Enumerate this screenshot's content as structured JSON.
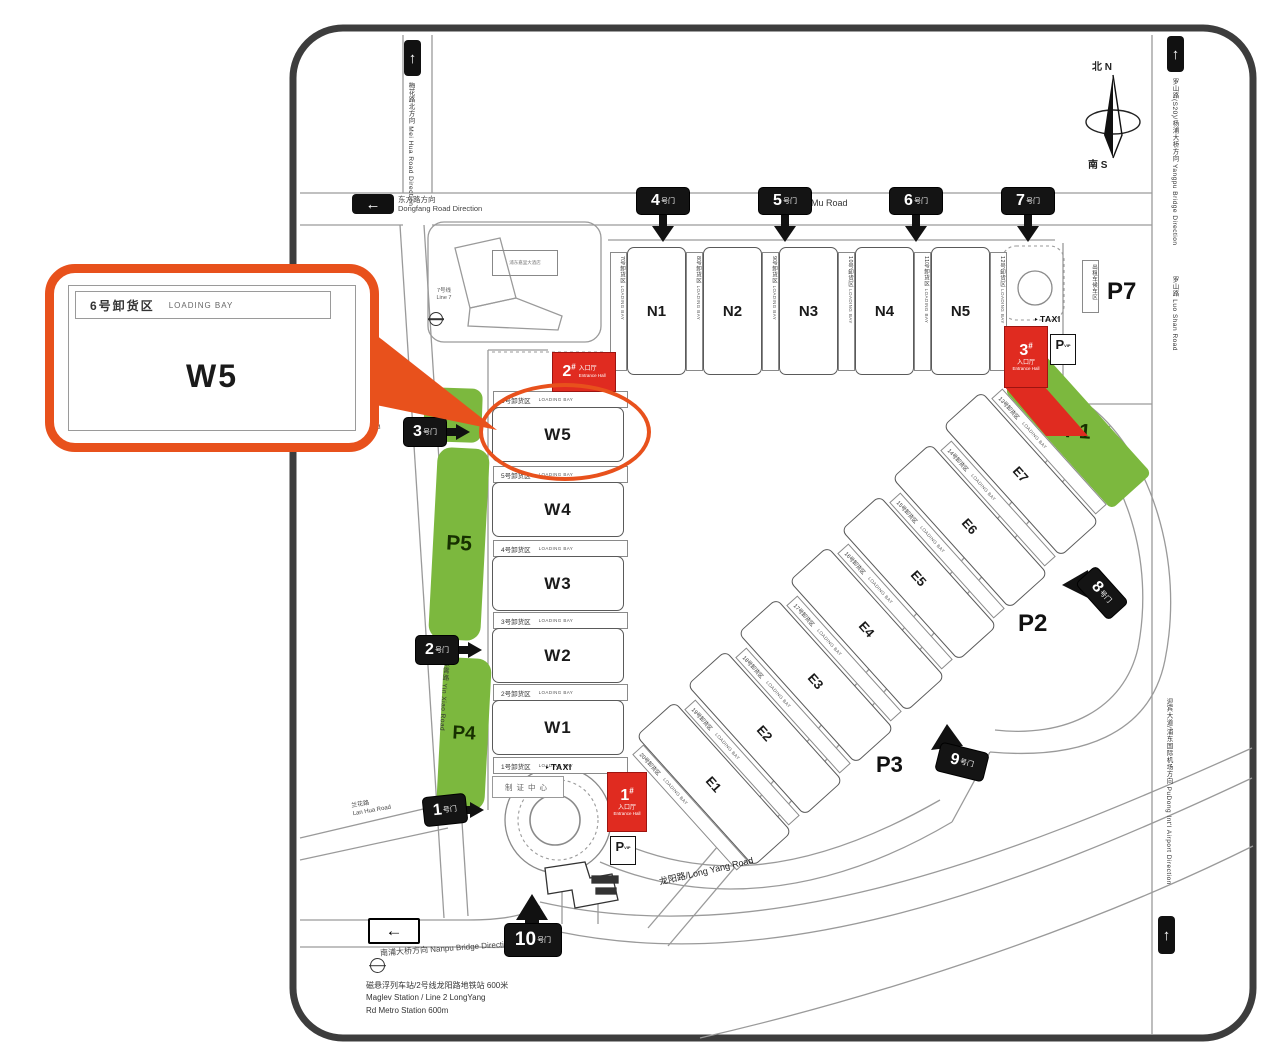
{
  "callout": {
    "bay": "6号卸货区",
    "bay_en": "LOADING BAY",
    "hall": "W5"
  },
  "compass": {
    "north": "北 N",
    "south": "南 S"
  },
  "roads": {
    "huamu": "花木路/ Hua Mu Road",
    "longyang": "龙阳路/Long Yang Road",
    "meihua_zh": "梅花路",
    "meihua_en": "Mei Hua Road",
    "lanhua_zh": "兰花路",
    "lanhua_en": "Lan Hua Road",
    "yinxiao": "银霄路 Yin Xiao Road",
    "meihua_north": "梅花路北方向 Mei Hua Road Direction",
    "dongfang_zh": "东方路方向",
    "dongfang_en": "Dongfang Road Direction",
    "nanpu_zh": "南浦大桥方向",
    "nanpu_en": "Nanpu Bridge Direction",
    "yangpu": "罗山路(S20)/杨浦大桥方向 Yangpu Bridge Direction",
    "luoshan": "罗山路 Luo Shan Road",
    "airport": "迎宾大道/浦东国际机场方向 PuDong Int'l Airport Direction",
    "up_arrow": "↑",
    "left_arrow": "←"
  },
  "gates": {
    "suffix": "号门",
    "items": [
      "1",
      "2",
      "3",
      "4",
      "5",
      "6",
      "7",
      "8",
      "9",
      "10"
    ]
  },
  "entrances": {
    "zh": "入口厅",
    "en": "Entrance Hall",
    "hash": "#",
    "items": [
      "1",
      "2",
      "3"
    ]
  },
  "halls": {
    "north": [
      "N1",
      "N2",
      "N3",
      "N4",
      "N5"
    ],
    "west": [
      "W5",
      "W4",
      "W3",
      "W2",
      "W1"
    ],
    "east": [
      "E7",
      "E6",
      "E5",
      "E4",
      "E3",
      "E2",
      "E1"
    ]
  },
  "bays": {
    "en": "LOADING BAY",
    "west": [
      "6号卸货区",
      "5号卸货区",
      "4号卸货区",
      "3号卸货区",
      "2号卸货区",
      "1号卸货区"
    ],
    "north": [
      "7号卸货区",
      "8号卸货区",
      "9号卸货区",
      "10号卸货区",
      "11号卸货区",
      "12号卸货区"
    ],
    "east": [
      "13号卸货区",
      "14号卸货区",
      "15号卸货区",
      "16号卸货区",
      "17号卸货区",
      "18号卸货区",
      "19号卸货区",
      "20号卸货区"
    ]
  },
  "parking": {
    "green": [
      "P6",
      "P5",
      "P4",
      "P1"
    ],
    "open": [
      "P7",
      "P2",
      "P3"
    ],
    "vip": "P",
    "vip_sub": "VIP"
  },
  "poi": {
    "taxi": "TAXI",
    "badge": "制证中心",
    "line7_zh": "7号线",
    "line7_en": "Line 7",
    "hotel": "浦东嘉里大酒店",
    "taxi_area": "出租车候车区"
  },
  "footer": {
    "l1": "磁悬浮列车站/2号线龙阳路地铁站 600米",
    "l2": "Maglev Station / Line 2 LongYang",
    "l3": "Rd Metro Station 600m"
  }
}
